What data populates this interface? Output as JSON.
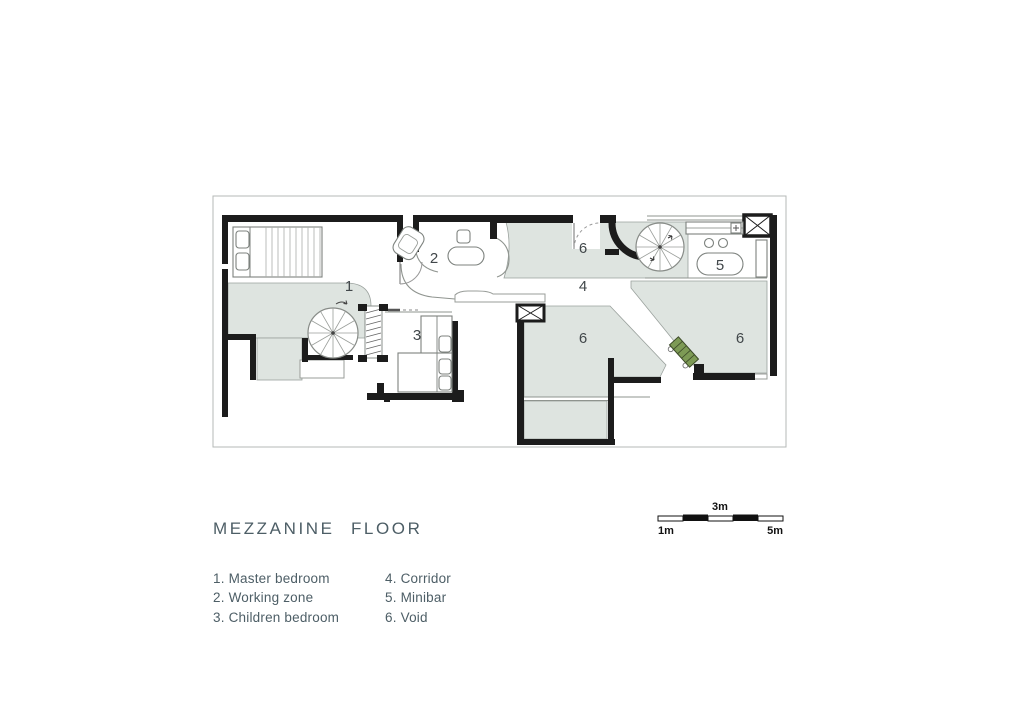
{
  "plan": {
    "rooms": [
      {
        "number": "1",
        "name": "Master bedroom"
      },
      {
        "number": "2",
        "name": "Working zone"
      },
      {
        "number": "3",
        "name": "Children bedroom"
      },
      {
        "number": "4",
        "name": "Corridor"
      },
      {
        "number": "5",
        "name": "Minibar"
      },
      {
        "number": "6",
        "name": "Void"
      }
    ],
    "labels": [
      "1",
      "2",
      "3",
      "4",
      "5",
      "6",
      "6",
      "6"
    ]
  },
  "legend": {
    "title": "MEZZANINE FLOOR",
    "columns": [
      [
        "1. Master bedroom",
        "2. Working zone",
        "3. Children bedroom"
      ],
      [
        "4. Corridor",
        "5. Minibar",
        "6. Void"
      ]
    ]
  },
  "scale_bar": {
    "top_label": "3m",
    "left_label": "1m",
    "right_label": "5m",
    "total_meters": 5,
    "segments": 5
  },
  "colors": {
    "wall": "#1c1c1c",
    "void_fill": "#dee4e0",
    "planter": "#7d9a55",
    "text": "#4d5e66"
  }
}
